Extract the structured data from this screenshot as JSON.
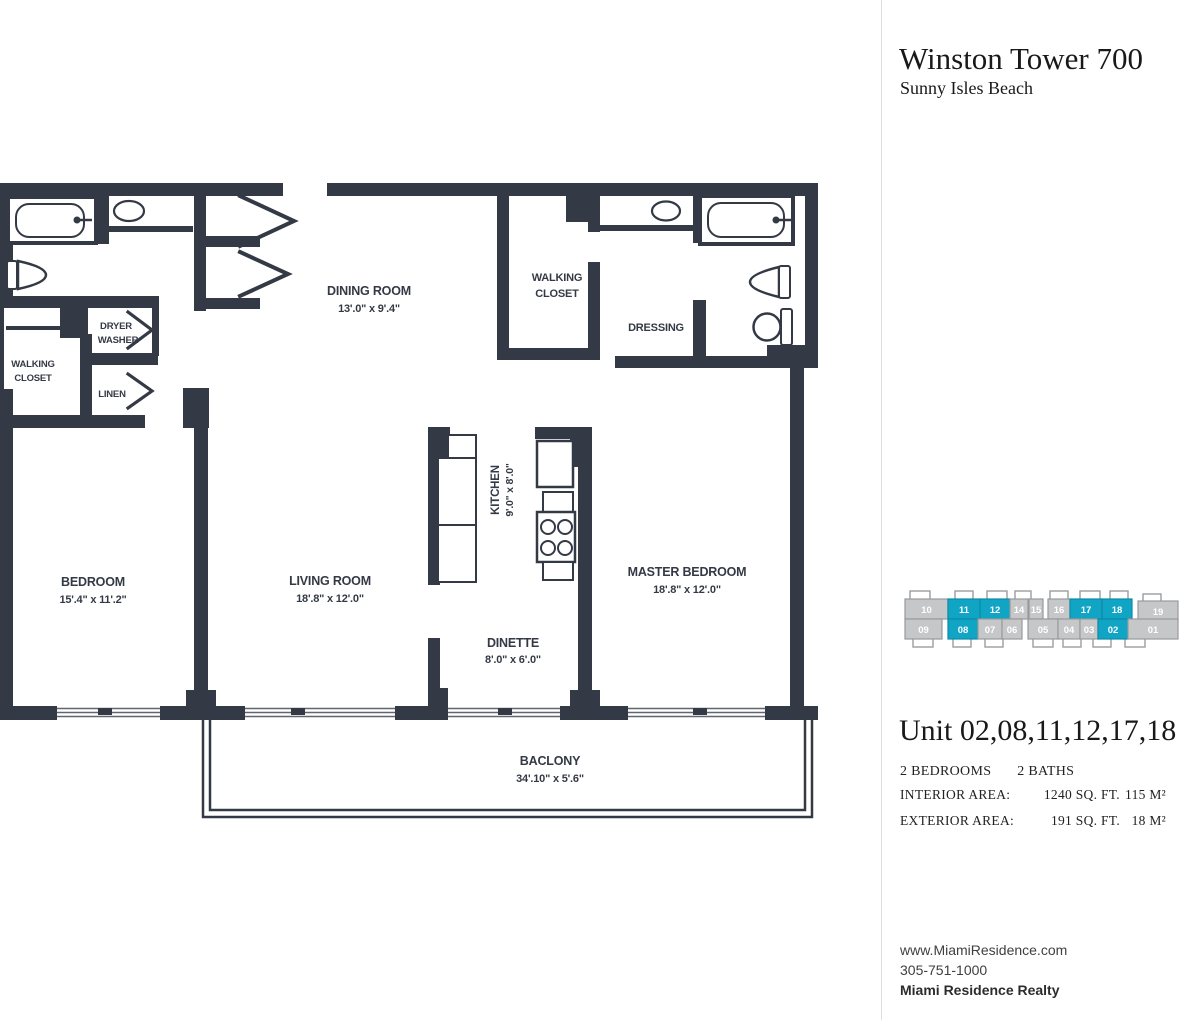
{
  "header": {
    "building": "Winston Tower 700",
    "location": "Sunny Isles Beach"
  },
  "floor_plan": {
    "rooms": {
      "bedroom": {
        "name": "BEDROOM",
        "dims": "15'.4\" x 11'.2\""
      },
      "living_room": {
        "name": "LIVING ROOM",
        "dims": "18'.8\" x 12'.0\""
      },
      "dining_room": {
        "name": "DINING ROOM",
        "dims": "13'.0\" x 9'.4\""
      },
      "kitchen": {
        "name": "KITCHEN",
        "dims": "9'.0\" x 8'.0\""
      },
      "dinette": {
        "name": "DINETTE",
        "dims": "8'.0\" x 6'.0\""
      },
      "master_bedroom": {
        "name": "MASTER BEDROOM",
        "dims": "18'.8\" x 12'.0\""
      },
      "balcony": {
        "name": "BACLONY",
        "dims": "34'.10\" x 5'.6\""
      },
      "walking_closet_center": {
        "line1": "WALKING",
        "line2": "CLOSET"
      },
      "walking_closet_left": {
        "line1": "WALKING",
        "line2": "CLOSET"
      },
      "dryer_washer": {
        "line1": "DRYER",
        "line2": "WASHER"
      },
      "linen": {
        "name": "LINEN"
      },
      "dressing": {
        "name": "DRESSING"
      }
    }
  },
  "unit_map": {
    "highlight_color": "#10a5c5",
    "top_row": [
      {
        "label": "10",
        "hl": false
      },
      {
        "label": "11",
        "hl": true
      },
      {
        "label": "12",
        "hl": true
      },
      {
        "label": "14",
        "hl": false
      },
      {
        "label": "15",
        "hl": false
      },
      {
        "label": "16",
        "hl": false
      },
      {
        "label": "17",
        "hl": true
      },
      {
        "label": "18",
        "hl": true
      },
      {
        "label": "19",
        "hl": false
      }
    ],
    "bottom_row": [
      {
        "label": "09",
        "hl": false
      },
      {
        "label": "08",
        "hl": true
      },
      {
        "label": "07",
        "hl": false
      },
      {
        "label": "06",
        "hl": false
      },
      {
        "label": "05",
        "hl": false
      },
      {
        "label": "04",
        "hl": false
      },
      {
        "label": "03",
        "hl": false
      },
      {
        "label": "02",
        "hl": true
      },
      {
        "label": "01",
        "hl": false
      }
    ]
  },
  "unit_info": {
    "title": "Unit 02,08,11,12,17,18",
    "bedrooms": "2 BEDROOMS",
    "baths": "2 BATHS",
    "interior_label": "INTERIOR AREA:",
    "interior_sqft": "1240 SQ. FT.",
    "interior_m2": "115 M²",
    "exterior_label": "EXTERIOR AREA:",
    "exterior_sqft": "191 SQ. FT.",
    "exterior_m2": "18 M²"
  },
  "footer": {
    "website": "www.MiamiResidence.com",
    "phone": "305-751-1000",
    "company": "Miami Residence Realty"
  }
}
